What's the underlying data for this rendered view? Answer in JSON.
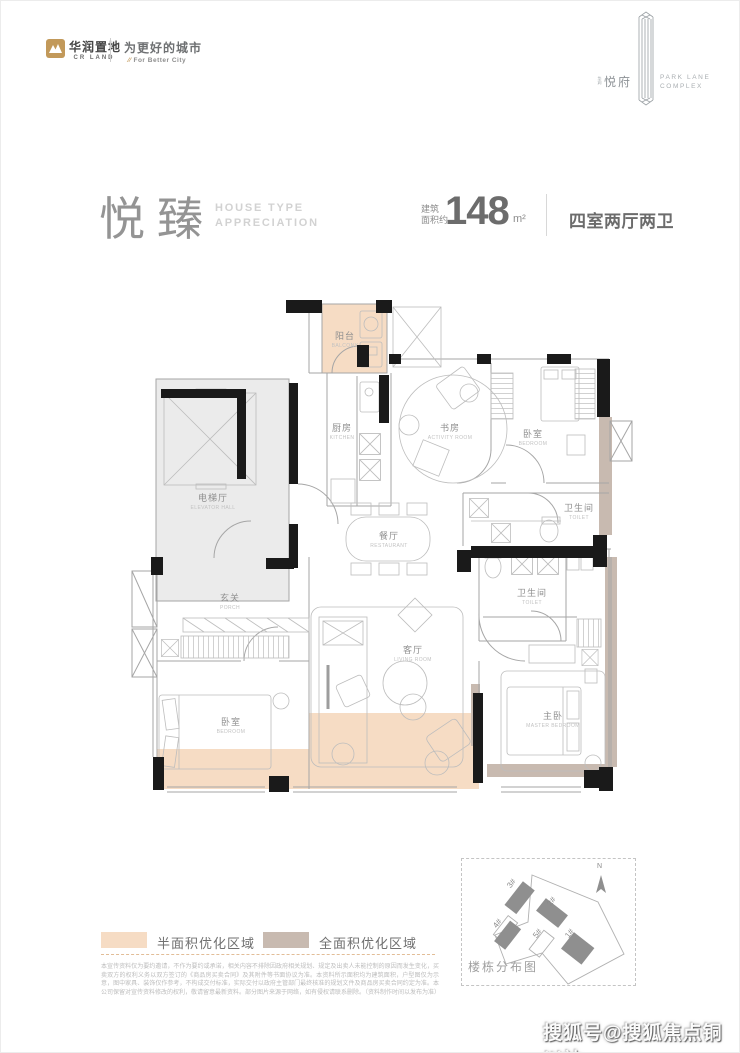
{
  "brand": {
    "logo_text": "华润置地",
    "logo_sub": "CR LAND",
    "slogan": "为更好的城市",
    "slogan_mark": "⁄⁄",
    "slogan_sub": "For Better City",
    "gold_color": "#c2995a"
  },
  "project": {
    "name_small": "华润",
    "name": "悦府",
    "name_en_line1": "PARK LANE",
    "name_en_line2": "COMPLEX"
  },
  "title": {
    "cn": "悦臻",
    "en_line1": "HOUSE TYPE",
    "en_line2": "APPRECIATION",
    "area_label_line1": "建筑",
    "area_label_line2": "面积约",
    "area_value": "148",
    "area_unit": "m²",
    "layout": "四室两厅两卫"
  },
  "plan": {
    "rooms": [
      {
        "cn": "阳台",
        "en": "BALCONY"
      },
      {
        "cn": "厨房",
        "en": "KITCHEN"
      },
      {
        "cn": "书房",
        "en": "ACTIVITY ROOM"
      },
      {
        "cn": "卧室",
        "en": "BEDROOM"
      },
      {
        "cn": "电梯厅",
        "en": "ELEVATOR HALL"
      },
      {
        "cn": "餐厅",
        "en": "RESTAURANT"
      },
      {
        "cn": "卫生间",
        "en": "TOILET"
      },
      {
        "cn": "玄关",
        "en": "PORCH"
      },
      {
        "cn": "卫生间",
        "en": "TOILET"
      },
      {
        "cn": "客厅",
        "en": "LIVING ROOM"
      },
      {
        "cn": "卧室",
        "en": "BEDROOM"
      },
      {
        "cn": "主卧",
        "en": "MASTER BEDROOM"
      }
    ],
    "wall_color": "#1a1a1a",
    "half_opt_color": "#f6dcc4",
    "full_opt_color": "#c8bab0",
    "hall_color": "#ebebeb"
  },
  "legend": {
    "items": [
      {
        "label": "半面积优化区域",
        "color": "#f6dcc4"
      },
      {
        "label": "全面积优化区域",
        "color": "#c8bab0"
      }
    ]
  },
  "disclaimer_lines": [
    "本宣传资料仅为要约邀请，不作为要约或承诺，相关内容不排除因政府相关规划、规定及出卖人未能控制的原因而发生变化，买卖双方的权利义务以双方签订的《商品房买卖合同》及其附件等书面协议为准。",
    "本资料所示面积均为建筑面积，户型图仅为示意，图中家具、装饰仅作参考，不构成交付标准，实际交付以政府主管部门最终核准的规划文件及商品房买卖合同约定为准。",
    "本公司保留对宣传资料修改的权利，敬请留意最新资料。部分图片来源于网络，如有侵权请联系删除。（资料制作时间以发布为准）"
  ],
  "sitemap": {
    "title": "楼栋分布图",
    "north_label": "N",
    "buildings": [
      {
        "label": "3#"
      },
      {
        "label": "2#"
      },
      {
        "label": "4#"
      },
      {
        "label": "5#"
      },
      {
        "label": "1#"
      }
    ]
  },
  "watermark": "搜狐号@搜狐焦点铜川站"
}
